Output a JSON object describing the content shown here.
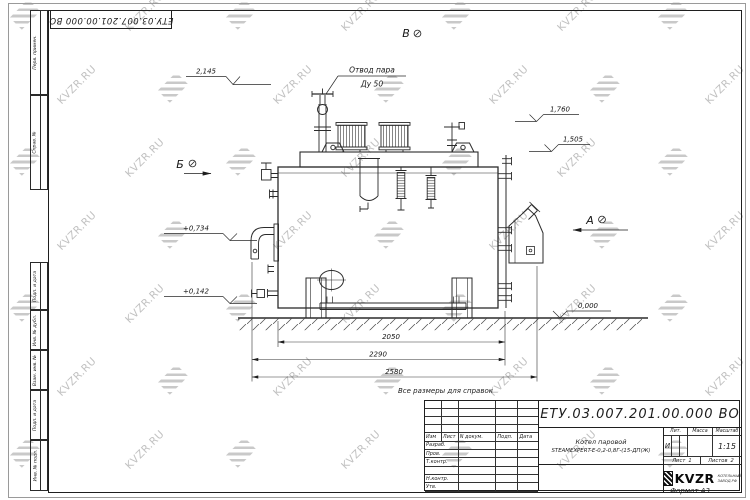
{
  "watermark": {
    "text": "KVZR.RU"
  },
  "corner_stamp": {
    "designation": "ЕТУ.03.007.201.00.000  ВО"
  },
  "margin": {
    "cells": [
      "Перв. примен.",
      "Справ. №",
      "Подп. и дата",
      "Инв. № дубл.",
      "Взам. инв. №",
      "Подп. и дата",
      "Инв. № подл."
    ]
  },
  "notes": {
    "reference": "Все размеры для справок",
    "format": "Формат А3"
  },
  "views": {
    "b": "Б",
    "v": "В",
    "a": "А"
  },
  "callout": {
    "line1": "Отвод пара",
    "line2": "Ду 50"
  },
  "elevations": {
    "top": "2,145",
    "safety": "1,760",
    "platform": "1,505",
    "burner": "+0,734",
    "drain": "+0,142",
    "ground": "0,000"
  },
  "dims": {
    "inner": "2050",
    "middle": "2290",
    "overall": "2580"
  },
  "title_block": {
    "designation": "ЕТУ.03.007.201.00.000  ВО",
    "header": {
      "izm": "Изм",
      "list": "Лист",
      "ndoc": "N докум.",
      "podp": "Подп.",
      "data": "Дата"
    },
    "rows": [
      "Разраб.",
      "Пров.",
      "Т.контр.",
      "",
      "Н.контр.",
      "Утв."
    ],
    "product": {
      "line1": "Котел паровой",
      "line2": "STEAMEXPERT-E-0,2-0,8Г-(15-ДП(Ж)"
    },
    "lit": {
      "label": "Лит.",
      "value": "И"
    },
    "mass": {
      "label": "Масса"
    },
    "scale": {
      "label": "Масштаб",
      "value": "1:15"
    },
    "sheet": {
      "label": "Лист",
      "value": "1"
    },
    "sheets": {
      "label": "Листов",
      "value": "2"
    },
    "company": {
      "name": "KVZR",
      "sub1": "КОТЕЛЬНЫЙ",
      "sub2": "ЗАВОД.РФ"
    }
  }
}
